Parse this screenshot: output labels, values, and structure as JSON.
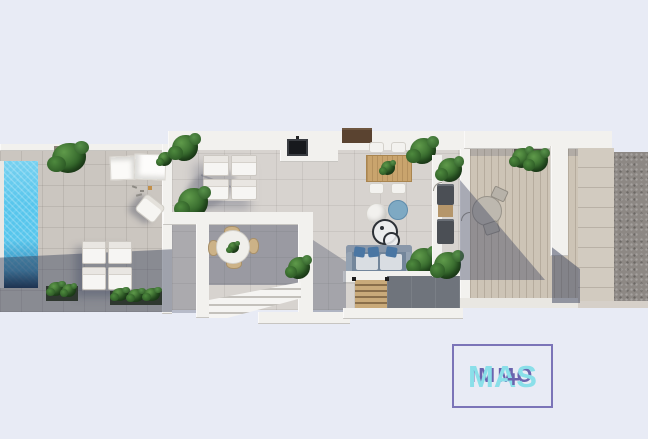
{
  "watermark": {
    "line1": "IMMO",
    "line2": "MAS",
    "plus": "+"
  },
  "colors": {
    "bg": "#e8ebf5",
    "wmBorder": "#7b74b8",
    "wmPurple": "#6b64ae",
    "wmCyan": "#8adfe9",
    "wall": "#f2f1ee",
    "tile": "#cbc6c0",
    "floor": "#d7d3cf",
    "deck": "#cdc4b6",
    "stone": "#d2cbc0",
    "gravel": "#8d8884",
    "pool": "#58c6ec",
    "poolDeep": "#082648",
    "shadow": "rgba(58,66,92,0.45)",
    "plant": "#2f6128",
    "wood": "#c9a46d",
    "woodSteps": "#c9aa7a",
    "unit": "#4b4f55",
    "sofa": "#73869b",
    "pillow": "#4a76a3",
    "tv": "#17191d"
  }
}
